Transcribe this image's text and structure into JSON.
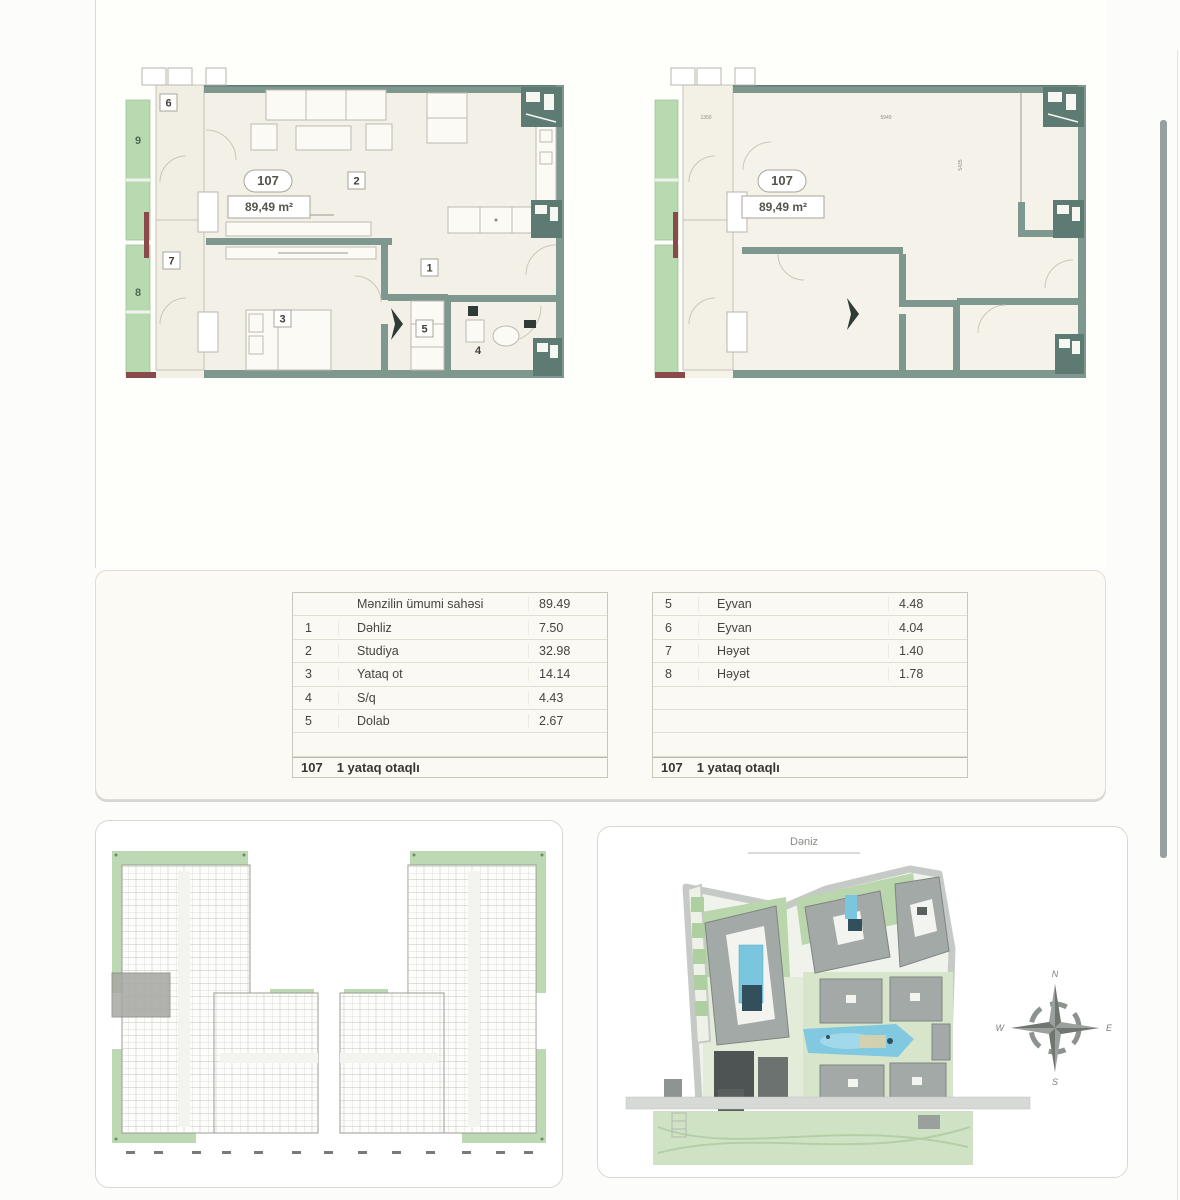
{
  "plans": {
    "left": {
      "unit_number": "107",
      "area_label": "89,49 m²",
      "markers": {
        "m1": "1",
        "m2": "2",
        "m3": "3",
        "m4": "4",
        "m5": "5",
        "m6": "6",
        "m7": "7",
        "m8": "8",
        "m9": "9"
      }
    },
    "right": {
      "unit_number": "107",
      "area_label": "89,49 m²",
      "dims": {
        "top_left": "1350",
        "top_right": "5949",
        "right_vertical": "5435"
      }
    }
  },
  "area_tables": {
    "left": {
      "header_label": "Mənzilin ümumi sahəsi",
      "header_value": "89.49",
      "rows": [
        {
          "num": "1",
          "label": "Dəhliz",
          "value": "7.50"
        },
        {
          "num": "2",
          "label": "Studiya",
          "value": "32.98"
        },
        {
          "num": "3",
          "label": "Yataq ot",
          "value": "14.14"
        },
        {
          "num": "4",
          "label": "S/q",
          "value": "4.43"
        },
        {
          "num": "5",
          "label": "Dolab",
          "value": "2.67"
        }
      ],
      "footer_unit": "107",
      "footer_label": "1 yataq otaqlı"
    },
    "right": {
      "rows": [
        {
          "num": "5",
          "label": "Eyvan",
          "value": "4.48"
        },
        {
          "num": "6",
          "label": "Eyvan",
          "value": "4.04"
        },
        {
          "num": "7",
          "label": "Həyət",
          "value": "1.40"
        },
        {
          "num": "8",
          "label": "Həyət",
          "value": "1.78"
        }
      ],
      "footer_unit": "107",
      "footer_label": "1 yataq otaqlı"
    }
  },
  "site_plan": {
    "title": "Dəniz",
    "compass": {
      "north": "N",
      "east": "E",
      "south": "S",
      "west": "W"
    }
  },
  "colors": {
    "wall": "#7e978f",
    "wall_dark": "#5d7b73",
    "room_fill": "#f3f0e7",
    "balcony_green": "#b7dab1",
    "accent_maroon": "#8a4a4a",
    "pool_blue": "#7fc9e0",
    "building_gray": "#a3a9a6",
    "highlight_gray": "#a6a6a2",
    "scrollbar": "#97a09e"
  }
}
